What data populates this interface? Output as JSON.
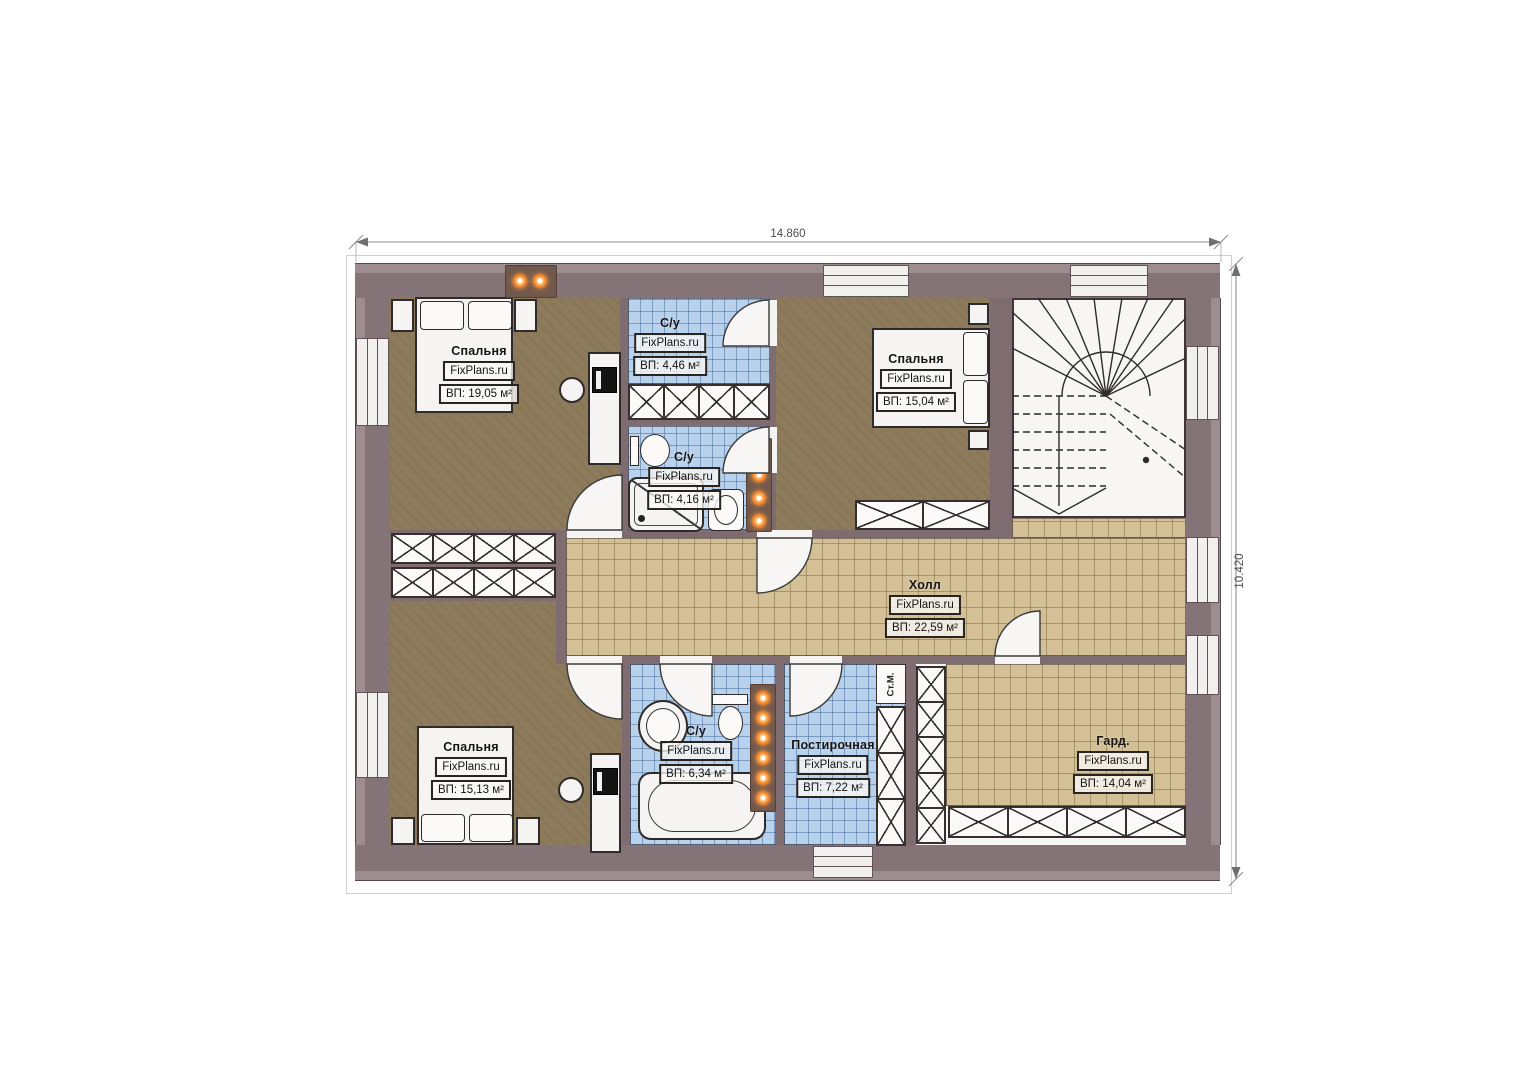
{
  "dimensions": {
    "width_label": "14.860",
    "height_label": "10.420"
  },
  "rooms": [
    {
      "name": "Спальня",
      "watermark": "FixPlans.ru",
      "area": "ВП: 19,05 м²"
    },
    {
      "name": "С/у",
      "watermark": "FixPlans.ru",
      "area": "ВП: 4,46 м²"
    },
    {
      "name": "С/у",
      "watermark": "FixPlans.ru",
      "area": "ВП: 4,16 м²"
    },
    {
      "name": "Спальня",
      "watermark": "FixPlans.ru",
      "area": "ВП: 15,04 м²"
    },
    {
      "name": "Холл",
      "watermark": "FixPlans.ru",
      "area": "ВП: 22,59 м²"
    },
    {
      "name": "Спальня",
      "watermark": "FixPlans.ru",
      "area": "ВП: 15,13 м²"
    },
    {
      "name": "С/у",
      "watermark": "FixPlans.ru",
      "area": "ВП: 6,34 м²"
    },
    {
      "name": "Постирочная",
      "watermark": "FixPlans.ru",
      "area": "ВП: 7,22 м²"
    },
    {
      "name": "Гард.",
      "watermark": "FixPlans.ru",
      "area": "ВП: 14,04 м²"
    }
  ],
  "labels": {
    "washing_machine": "Ст.М."
  },
  "colors": {
    "wall": "#87767a",
    "floor_wood": "#8d7b5b",
    "tile_blue": "#b8d2ee",
    "tile_beige": "#d3c096",
    "lamp_orange": "#e87f2e"
  }
}
